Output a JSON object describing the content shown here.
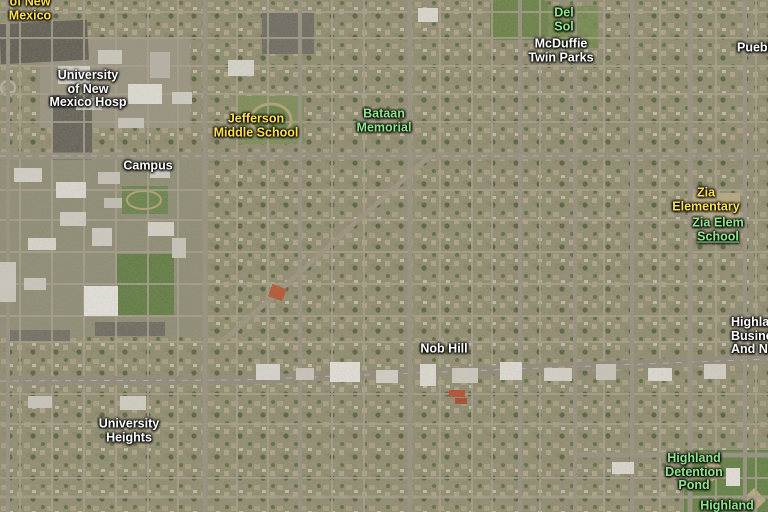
{
  "map": {
    "view_type": "satellite",
    "label_colors": {
      "white": "#ffffff",
      "yellow": "#ffe04d",
      "green": "#8de88c"
    },
    "labels": [
      {
        "name": "label-of-new-mexico",
        "lines": [
          "of New",
          "Mexico"
        ],
        "color": "yellow",
        "x": 30,
        "y": 9
      },
      {
        "name": "label-university-of-new-mexico-hosp",
        "lines": [
          "University",
          "of New",
          "Mexico Hosp"
        ],
        "color": "white",
        "x": 88,
        "y": 89
      },
      {
        "name": "label-campus",
        "lines": [
          "Campus"
        ],
        "color": "white",
        "x": 148,
        "y": 166
      },
      {
        "name": "label-jefferson-middle-school",
        "lines": [
          "Jefferson",
          "Middle School"
        ],
        "color": "yellow",
        "x": 256,
        "y": 126
      },
      {
        "name": "label-bataan-memorial",
        "lines": [
          "Bataan",
          "Memorial"
        ],
        "color": "green",
        "x": 384,
        "y": 121
      },
      {
        "name": "label-del-sol",
        "lines": [
          "Del",
          "Sol"
        ],
        "color": "green",
        "x": 564,
        "y": 20
      },
      {
        "name": "label-mcduffie-twin-parks",
        "lines": [
          "McDuffie",
          "Twin Parks"
        ],
        "color": "white",
        "x": 561,
        "y": 51
      },
      {
        "name": "label-pueblo",
        "lines": [
          "Pueblo"
        ],
        "color": "white",
        "x": 737,
        "y": 48,
        "align": "left"
      },
      {
        "name": "label-zia-elementary",
        "lines": [
          "Zia",
          "Elementary"
        ],
        "color": "yellow",
        "x": 706,
        "y": 200
      },
      {
        "name": "label-zia-elem-school",
        "lines": [
          "Zia Elem",
          "School"
        ],
        "color": "green",
        "x": 718,
        "y": 230,
        "underline_line": 1,
        "link": true
      },
      {
        "name": "label-highland-business",
        "lines": [
          "Highland",
          "Business",
          "And N"
        ],
        "color": "white",
        "x": 731,
        "y": 336,
        "align": "left"
      },
      {
        "name": "label-nob-hill",
        "lines": [
          "Nob Hill"
        ],
        "color": "white",
        "x": 444,
        "y": 349
      },
      {
        "name": "label-university-heights",
        "lines": [
          "University",
          "Heights"
        ],
        "color": "white",
        "x": 129,
        "y": 431
      },
      {
        "name": "label-highland-detention-pond",
        "lines": [
          "Highland",
          "Detention",
          "Pond"
        ],
        "color": "green",
        "x": 694,
        "y": 472
      },
      {
        "name": "label-highland",
        "lines": [
          "Highland"
        ],
        "color": "green",
        "x": 727,
        "y": 506
      }
    ]
  }
}
